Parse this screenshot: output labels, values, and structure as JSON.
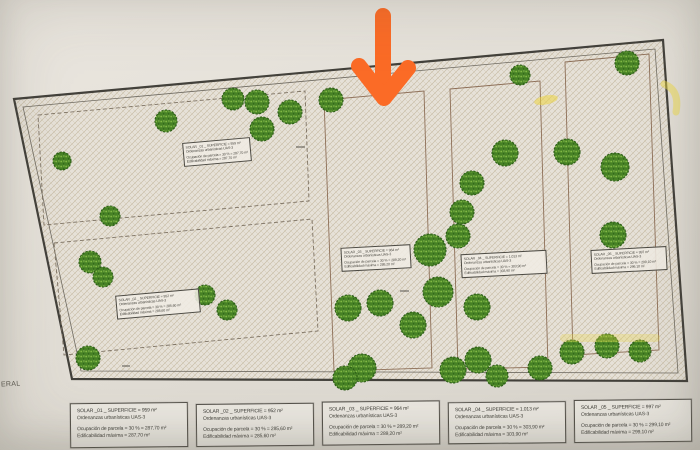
{
  "meta": {
    "margin_text": "ERAL"
  },
  "annotation": {
    "arrow_icon": "orange-down-arrow",
    "arrow_color": "#fb6b26",
    "highlighter_color": "#ecd640"
  },
  "legend": {
    "parcels": [
      {
        "name": "SOLAR _01",
        "superficie": "SOLAR _01 _ SUPERFICIE = 959 m²",
        "ordenanzas": "Ordenanzas urbanísticas UAS-3",
        "ocupacion": "Ocupación de parcela = 30 % = 287,70 m²",
        "edificabilidad": "Edificabilidad máxima  = 287,70 m²"
      },
      {
        "name": "SOLAR _02",
        "superficie": "SOLAR _02 _ SUPERFICIE = 952 m²",
        "ordenanzas": "Ordenanzas urbanísticas UAS-3",
        "ocupacion": "Ocupación de parcela = 30 % = 285,60 m²",
        "edificabilidad": "Edificabilidad máxima  = 285,60 m²"
      },
      {
        "name": "SOLAR _03",
        "superficie": "SOLAR _03 _ SUPERFICIE = 964 m²",
        "ordenanzas": "Ordenanzas urbanísticas UAS-3",
        "ocupacion": "Ocupación de parcela = 30 % = 289,20 m²",
        "edificabilidad": "Edificabilidad máxima  = 289,20 m²"
      },
      {
        "name": "SOLAR _04",
        "superficie": "SOLAR _04 _ SUPERFICIE = 1.013 m²",
        "ordenanzas": "Ordenanzas urbanísticas UAS-3",
        "ocupacion": "Ocupación de parcela = 30 % = 303,90 m²",
        "edificabilidad": "Edificabilidad máxima  = 303,90 m²"
      },
      {
        "name": "SOLAR _05",
        "superficie": "SOLAR _05 _ SUPERFICIE = 997 m²",
        "ordenanzas": "Ordenanzas urbanísticas UAS-3",
        "ocupacion": "Ocupación de parcela = 30 % = 299,10 m²",
        "edificabilidad": "Edificabilidad máxima  = 299,10 m²"
      }
    ]
  },
  "plan": {
    "colors": {
      "paper": "#e4e0d8",
      "boundary": "#43413b",
      "parcel_line": "#96705a",
      "hatch_line": "#c3b79f",
      "tree_fill": "#4a8527",
      "tree_dot": "#8abb49",
      "tree_edge": "#2d5f18"
    },
    "labels": [
      {
        "x": 183,
        "y": 140,
        "w": 62,
        "rot": -5
      },
      {
        "x": 116,
        "y": 292,
        "w": 78,
        "rot": -5
      },
      {
        "x": 341,
        "y": 246,
        "w": 64,
        "rot": -3
      },
      {
        "x": 461,
        "y": 252,
        "w": 80,
        "rot": -3
      },
      {
        "x": 591,
        "y": 248,
        "w": 70,
        "rot": -3
      }
    ],
    "trees": [
      [
        62,
        161,
        9
      ],
      [
        166,
        121,
        11
      ],
      [
        233,
        99,
        11
      ],
      [
        257,
        102,
        12
      ],
      [
        290,
        112,
        12
      ],
      [
        262,
        129,
        12
      ],
      [
        110,
        216,
        10
      ],
      [
        90,
        262,
        11
      ],
      [
        103,
        277,
        10
      ],
      [
        205,
        295,
        10
      ],
      [
        227,
        310,
        10
      ],
      [
        88,
        358,
        12
      ],
      [
        331,
        100,
        12
      ],
      [
        520,
        75,
        10
      ],
      [
        627,
        63,
        12
      ],
      [
        505,
        153,
        13
      ],
      [
        567,
        152,
        13
      ],
      [
        615,
        167,
        14
      ],
      [
        472,
        183,
        12
      ],
      [
        462,
        212,
        12
      ],
      [
        458,
        236,
        12
      ],
      [
        430,
        250,
        16
      ],
      [
        613,
        235,
        13
      ],
      [
        438,
        292,
        15
      ],
      [
        477,
        307,
        13
      ],
      [
        348,
        308,
        13
      ],
      [
        380,
        303,
        13
      ],
      [
        413,
        325,
        13
      ],
      [
        362,
        368,
        14
      ],
      [
        345,
        378,
        12
      ],
      [
        453,
        370,
        13
      ],
      [
        478,
        360,
        13
      ],
      [
        540,
        368,
        12
      ],
      [
        572,
        352,
        12
      ],
      [
        607,
        346,
        12
      ],
      [
        640,
        351,
        11
      ],
      [
        497,
        376,
        11
      ]
    ]
  }
}
